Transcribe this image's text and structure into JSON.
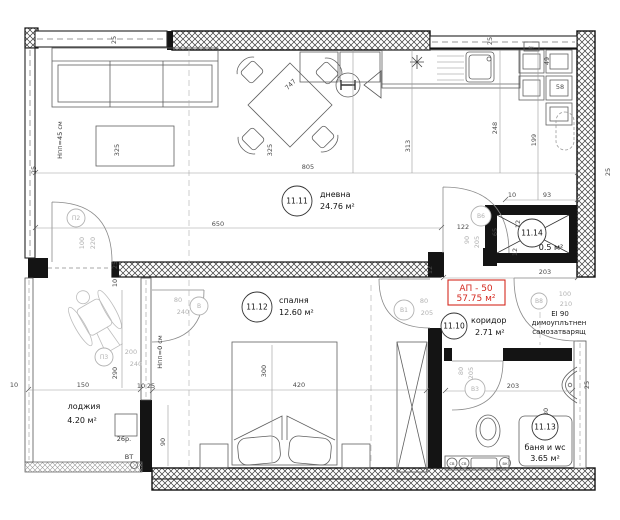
{
  "apartment": {
    "label": "АП - 50",
    "area": "57.75 м²",
    "accent_color": "#d42a20"
  },
  "rooms": [
    {
      "id": "11.11",
      "name": "дневна",
      "area": "24.76 м²",
      "circle": [
        297,
        201,
        15
      ],
      "name_pos": [
        320,
        197
      ],
      "area_pos": [
        320,
        209
      ],
      "anchor": "start"
    },
    {
      "id": "11.12",
      "name": "спалня",
      "area": "12.60 м²",
      "circle": [
        257,
        307,
        15
      ],
      "name_pos": [
        279,
        303
      ],
      "area_pos": [
        279,
        315
      ],
      "anchor": "start"
    },
    {
      "id": "11.10",
      "name": "коридор",
      "area": "2.71 м²",
      "circle": [
        454,
        326,
        13
      ],
      "name_pos": [
        471,
        323
      ],
      "area_pos": [
        475,
        335
      ],
      "anchor": "start"
    },
    {
      "id": "11.13",
      "name": "баня и wc",
      "area": "3.65 м²",
      "circle": [
        545,
        427,
        13
      ],
      "name_pos": [
        545,
        450
      ],
      "area_pos": [
        545,
        461
      ],
      "anchor": "middle"
    },
    {
      "id": "11.14",
      "name": "",
      "area": "0.5 м²",
      "circle": [
        532,
        233,
        14
      ],
      "name_pos": null,
      "area_pos": [
        551,
        250
      ],
      "anchor": "middle"
    },
    {
      "id": "",
      "name": "лоджия",
      "area": "4.20 м²",
      "circle": null,
      "name_pos": [
        84,
        409
      ],
      "area_pos": [
        82,
        423
      ],
      "anchor": "middle"
    }
  ],
  "doors": [
    {
      "letter": "П2",
      "circle": [
        76,
        218,
        9
      ],
      "labels": [
        {
          "t": "100",
          "x": 84,
          "y": 243,
          "r": -90
        },
        {
          "t": "220",
          "x": 95,
          "y": 243,
          "r": -90
        }
      ]
    },
    {
      "letter": "П3",
      "circle": [
        104,
        357,
        9
      ],
      "labels": [
        {
          "t": "200",
          "x": 131,
          "y": 354
        },
        {
          "t": "240",
          "x": 136,
          "y": 366
        }
      ]
    },
    {
      "letter": "В",
      "circle": [
        199,
        306,
        9
      ],
      "labels": [
        {
          "t": "80",
          "x": 178,
          "y": 302
        },
        {
          "t": "240",
          "x": 183,
          "y": 314
        }
      ]
    },
    {
      "letter": "В1",
      "circle": [
        404,
        310,
        10
      ],
      "labels": [
        {
          "t": "80",
          "x": 424,
          "y": 303
        },
        {
          "t": "205",
          "x": 427,
          "y": 315
        }
      ]
    },
    {
      "letter": "В6",
      "circle": [
        481,
        216,
        10
      ],
      "labels": [
        {
          "t": "90",
          "x": 469,
          "y": 240,
          "r": -90
        },
        {
          "t": "205",
          "x": 479,
          "y": 242,
          "r": -90
        }
      ]
    },
    {
      "letter": "В3",
      "circle": [
        475,
        389,
        10
      ],
      "labels": [
        {
          "t": "80",
          "x": 463,
          "y": 371,
          "r": -90
        },
        {
          "t": "205",
          "x": 473,
          "y": 373,
          "r": -90
        }
      ]
    },
    {
      "letter": "В8",
      "circle": [
        539,
        301,
        8
      ],
      "labels": [
        {
          "t": "100",
          "x": 565,
          "y": 296
        },
        {
          "t": "210",
          "x": 566,
          "y": 306
        }
      ]
    }
  ],
  "dimensions": [
    {
      "t": "25",
      "x": 116,
      "y": 40,
      "r": -90
    },
    {
      "t": "25",
      "x": 492,
      "y": 41,
      "r": -90
    },
    {
      "t": "25",
      "x": 36,
      "y": 170,
      "r": -90
    },
    {
      "t": "25",
      "x": 610,
      "y": 172,
      "r": -90
    },
    {
      "t": "25",
      "x": 117,
      "y": 265,
      "r": -90
    },
    {
      "t": "10",
      "x": 117,
      "y": 283,
      "r": -90
    },
    {
      "t": "805",
      "x": 308,
      "y": 169
    },
    {
      "t": "650",
      "x": 218,
      "y": 226
    },
    {
      "t": "747",
      "x": 292,
      "y": 86,
      "r": -45
    },
    {
      "t": "325",
      "x": 119,
      "y": 150,
      "r": -90
    },
    {
      "t": "325",
      "x": 272,
      "y": 150,
      "r": -90
    },
    {
      "t": "313",
      "x": 410,
      "y": 146,
      "r": -90
    },
    {
      "t": "248",
      "x": 497,
      "y": 128,
      "r": -90
    },
    {
      "t": "199",
      "x": 536,
      "y": 140,
      "r": -90
    },
    {
      "t": "49",
      "x": 549,
      "y": 61,
      "r": -90
    },
    {
      "t": "58",
      "x": 560,
      "y": 89
    },
    {
      "t": "10",
      "x": 512,
      "y": 197
    },
    {
      "t": "93",
      "x": 547,
      "y": 197
    },
    {
      "t": "65",
      "x": 497,
      "y": 232,
      "r": -90
    },
    {
      "t": "12",
      "x": 520,
      "y": 224,
      "r": -90
    },
    {
      "t": "12",
      "x": 517,
      "y": 252,
      "r": -90
    },
    {
      "t": "12",
      "x": 432,
      "y": 270,
      "r": -90
    },
    {
      "t": "203",
      "x": 545,
      "y": 274
    },
    {
      "t": "122",
      "x": 463,
      "y": 229
    },
    {
      "t": "150",
      "x": 83,
      "y": 387
    },
    {
      "t": "10",
      "x": 14,
      "y": 387
    },
    {
      "t": "290",
      "x": 117,
      "y": 373,
      "r": -90
    },
    {
      "t": "10",
      "x": 141,
      "y": 388
    },
    {
      "t": "25",
      "x": 151,
      "y": 388
    },
    {
      "t": "300",
      "x": 266,
      "y": 371,
      "r": -90
    },
    {
      "t": "420",
      "x": 299,
      "y": 387
    },
    {
      "t": "90",
      "x": 165,
      "y": 442,
      "r": -90
    },
    {
      "t": "80",
      "x": 548,
      "y": 412,
      "r": -90
    },
    {
      "t": "203",
      "x": 513,
      "y": 388
    },
    {
      "t": "25",
      "x": 589,
      "y": 385,
      "r": -90
    }
  ],
  "notes": [
    {
      "name": "fire-rating-line1",
      "t": "EI 90",
      "x": 560,
      "y": 316,
      "cls": "note"
    },
    {
      "name": "fire-rating-line2",
      "t": "димоуплътнен",
      "x": 559,
      "y": 325,
      "cls": "note"
    },
    {
      "name": "fire-rating-line3",
      "t": "самозатварящ",
      "x": 559,
      "y": 334,
      "cls": "note"
    },
    {
      "name": "floor-level-living",
      "t": "Hпп=45 см",
      "x": 62,
      "y": 140,
      "r": -90,
      "cls": "note-sm"
    },
    {
      "name": "floor-level-loggia",
      "t": "Hпп=0 см",
      "x": 162,
      "y": 352,
      "r": -90,
      "cls": "note-sm"
    },
    {
      "name": "riser-label",
      "t": "26р.",
      "x": 124,
      "y": 441,
      "cls": "note-sm"
    },
    {
      "name": "vent-pipe-label",
      "t": "ВТ",
      "x": 129,
      "y": 459,
      "cls": "note-sm"
    },
    {
      "name": "water-column-kitchen",
      "t": "вк",
      "x": 531,
      "y": 49,
      "cls": "tiny"
    },
    {
      "name": "water-meter-1",
      "t": "св",
      "x": 452,
      "y": 465,
      "cls": "tiny"
    },
    {
      "name": "water-meter-2",
      "t": "св",
      "x": 464,
      "y": 465,
      "cls": "tiny"
    },
    {
      "name": "water-column-bath",
      "t": "вк",
      "x": 505,
      "y": 465,
      "cls": "tiny"
    }
  ]
}
